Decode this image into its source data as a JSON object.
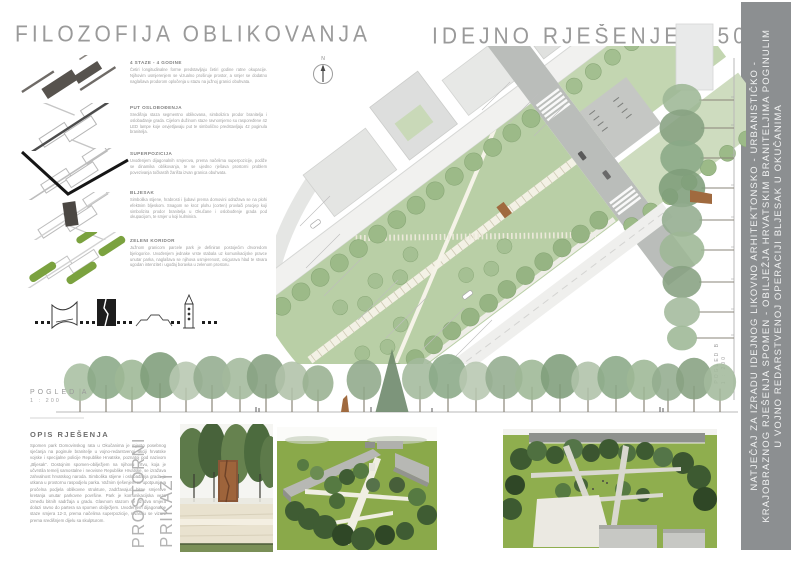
{
  "board": {
    "title_philosophy": "FILOZOFIJA OBLIKOVANJA",
    "title_solution": "IDEJNO RJEŠENJE 1:500"
  },
  "sidebar": {
    "lines": [
      "NATJEČAJ ZA IZRADU IDEJNOG LIKOVNO ARHITEKTONSKO - URBANISTIČKO -",
      "KRAJOBRAZNOG RJEŠENJA SPOMEN - OBILJEŽJA HRVATSKIM BRANITELJIMA POGINULIM",
      "U VOJNO REDARSTVENOJ OPERACIJI BLJESAK U OKUČANIMA"
    ]
  },
  "concepts": {
    "sections": [
      {
        "heading": "4 STAZE - 4 GODINE",
        "body": "Četiri longitudinalne forme predstavljaju četiri godine ratne okupacije. Njihovim usmjerenjem se vizualno proširuje prostor, a smjer se dodatno naglašava prodorom opločenja u stazu na južnoj granici obuhvata."
      },
      {
        "heading": "PUT OSLOBOĐENJA",
        "body": "Središnja staza segmentno oblikovana, simbolizira prodor branitelja i oslobađanje grada. Cijelom dužinom staze ravnomjerno su raspoređene 42 LED lampe koje osvjetljavaju put te simbolično predstavljaju 42 poginula branitelja."
      },
      {
        "heading": "SUPERPOZICIJA",
        "body": "Uvođenjem dijagonalnih smjerova, prema načelima superpozicije, podiže se dinamika oblikovanja, te se ujedno rješava prostorni problem povezivanja točkastih žarišta izvan granica obuhvata."
      },
      {
        "heading": "BLJESAK",
        "body": "Simbolika stijene, hrabrosti i ljubavi prema domovini odražava se na plohi efektnim bljeskom. Snagom se kroz plohu (corten) provlači procjep koji simbolizira prodor branitelja u Okučane i oslobođenje grada pod okupacijom, te smjer u koji kulminira."
      },
      {
        "heading": "ZELENI KORIDOR",
        "body": "Južnom granicom parcele park je definiran postojećim drvoredom bjelogorice. Uvođenjem jednake vrste stabala uz komunikacijske pravce unutar parka, naglašava se njihova usmjerenost, osigurava hlad te stvara ugodan intenzitet i ugođaj boravka u zelenom prostoru."
      },
      {
        "heading": "GENIUS LOCI",
        "body": "Središnja staza čini žilu kucavicu parka. Ujedno je veza koja spaja važne prostorne akcente. Glavno težište se nalazi na nenametljivoj skulpturi na središnjem parternom uređenju. Svojim procjepom vizualno povezuje ostale elemente unutar i izvan parka."
      }
    ]
  },
  "plan": {
    "north": "N"
  },
  "elevations": {
    "a_label": "POGLED A",
    "a_scale": "1 : 200",
    "b_label": "POGLED B",
    "b_scale": "1 : 200"
  },
  "description": {
    "heading": "OPIS RJEŠENJA",
    "body": "Spomen park Domovinskog rata u Okučanima je mjesto posebnog sjećanja na poginule branitelje u vojno-redarstvenoj akciji hrvatske vojske i specijalne policije Republike Hrvatske, poznatoj pod nazivom „Bljesak“. Dostojnim spomen-obilježjem na njihovu žrtvu, koja je učvrstila temelj samostalne i neovisne Republike Hrvatske, se izražava zahvalnost hrvatskog naroda. Simbolika stijene i oslobađanja grada je utkana u prostornu raspodjelu parka. Važnim rješenjem se upotpunjava pročelna podjela oblikovne strukture, zadržavajući bitne smjerove kretanja unutar parkovne površine. Park je komunikacijska veza između bitnih sadržaja u gradu. Glavnom stazom se uz dva smjera dolazi ravno do partera sa spomen obilježjem. Uvođenjem dijagonalne staze smjera 12-3, prema načelima superpozicije, stvaraju se vizure prema središnjem dijelu sa skulpturom."
  },
  "renders": {
    "label_line1": "PROSTORNI",
    "label_line2": "PRIKAZI"
  },
  "colors": {
    "sidebar_bg": "#8c8f91",
    "park_green": "#b9cfa6",
    "tree_green": "#9cba88",
    "render_lawn": "#83a443",
    "corten": "#a06a3f",
    "diagram_green": "#7ba23f"
  }
}
